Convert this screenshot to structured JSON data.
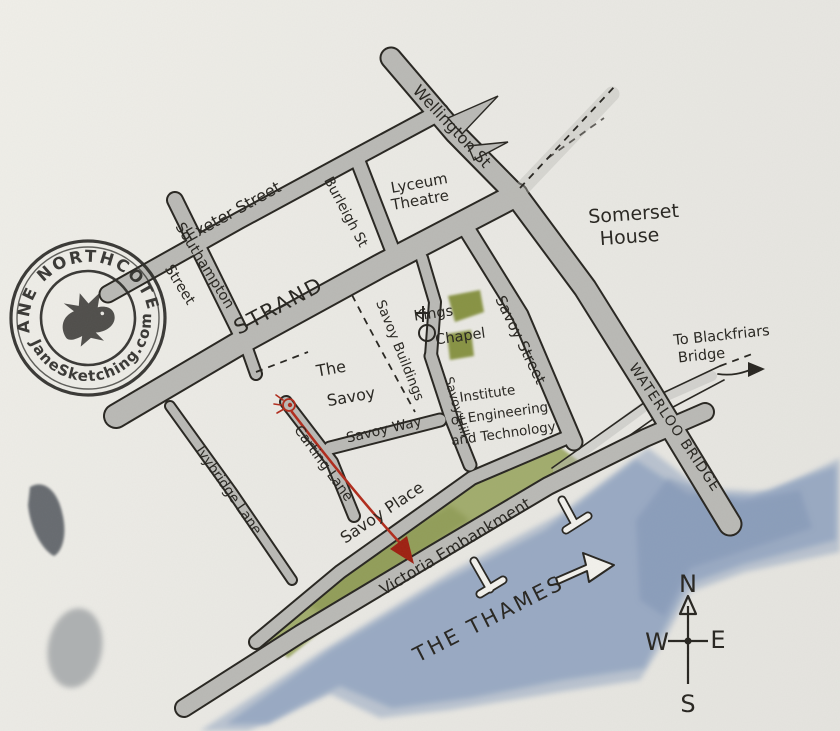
{
  "map": {
    "stamp": {
      "line1": "JANE NORTHCOTE",
      "line2": "JaneSketching.com"
    },
    "streets": {
      "wellington": "Wellington St",
      "exeter": "Exeter Street",
      "burleigh": "Burleigh St",
      "southampton1": "Southampton",
      "southampton2": "Street",
      "strand": "STRAND",
      "savoy_buildings": "Savoy Buildings",
      "savoy_street": "Savoy Street",
      "savoy_way": "Savoy Way",
      "savoy_hill": "Savoy Hill",
      "carting": "Carting Lane",
      "ivybridge": "Ivybridge Lane",
      "savoy_place": "Savoy Place",
      "victoria": "Victoria Embankment",
      "waterloo": "WATERLOO BRIDGE"
    },
    "places": {
      "lyceum1": "Lyceum",
      "lyceum2": "Theatre",
      "somerset1": "Somerset",
      "somerset2": "House",
      "the_savoy1": "The",
      "the_savoy2": "Savoy",
      "kings1": "Kings",
      "kings2": "Chapel",
      "iet1": "Institute",
      "iet2": "of Engineering",
      "iet3": "and Technology",
      "blackfriars1": "To Blackfriars",
      "blackfriars2": "Bridge",
      "thames": "THE THAMES"
    },
    "compass": {
      "n": "N",
      "e": "E",
      "s": "S",
      "w": "W"
    },
    "colors": {
      "road": "#b9b9b5",
      "water": "#93a5c1",
      "grass": "#98a45c",
      "ink": "#26241f",
      "red": "#b02a1a",
      "paper": "#eae9e4"
    }
  }
}
